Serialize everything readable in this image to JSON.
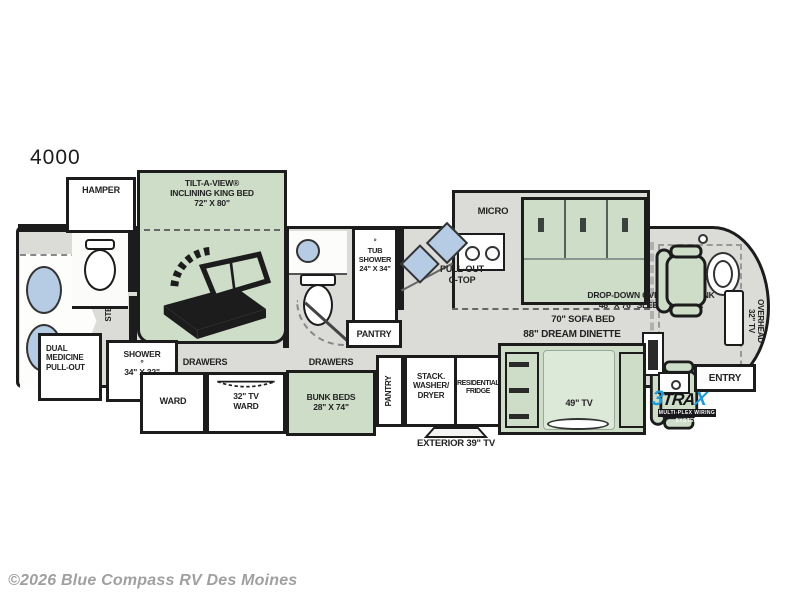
{
  "title": {
    "model": "4000"
  },
  "colors": {
    "room_green": "#cdddc8",
    "floor_gray": "#dbdbd8",
    "wall": "#1c1c1c",
    "fixture_blue": "#b5cce4",
    "logo_blue": "#1e9cd7"
  },
  "labels": {
    "hamper": "HAMPER",
    "king_bed": "TILT-A-VIEW®\nINCLINING KING BED\n72\" X 80\"",
    "step_up": "STEP-UP",
    "dual_medicine": "DUAL\nMEDICINE\nPULL-OUT",
    "shower": "SHOWER\n°\n34\" X 32\"",
    "drawers_left": "DRAWERS",
    "drawers_right": "DRAWERS",
    "ward": "WARD",
    "tv_ward": "32\" TV\nWARD",
    "bunk_beds": "BUNK BEDS\n28\" X 74\"",
    "tub_shower": "°\nTUB\nSHOWER\n24\" X 34\"",
    "pantry_bath": "PANTRY",
    "pantry_kitchen": "PANTRY",
    "micro": "MICRO",
    "pull_out_ctop": "PULL-OUT\nC-TOP",
    "sofa_bed": "70\" SOFA BED",
    "washer_dryer": "STACK.\nWASHER/\nDRYER",
    "fridge": "RESIDENTIAL\nFRIDGE",
    "exterior_tv": "EXTERIOR 39\" TV",
    "dream_dinette": "88\" DREAM DINETTE",
    "tv_49": "49\" TV",
    "overhead_bunk": "DROP-DOWN OVERHEAD BUNK\n48\" X 76\" SLEEPING AREA",
    "overhead_tv": "OVERHEAD\n32\" TV",
    "entry": "ENTRY"
  },
  "logo": {
    "part_3": "3",
    "part_tra": "TRA",
    "part_x": "X",
    "tagline": "MULTI-PLEX WIRING SYSTEM"
  },
  "footer": {
    "copyright": "©2026 Blue Compass RV Des Moines"
  }
}
